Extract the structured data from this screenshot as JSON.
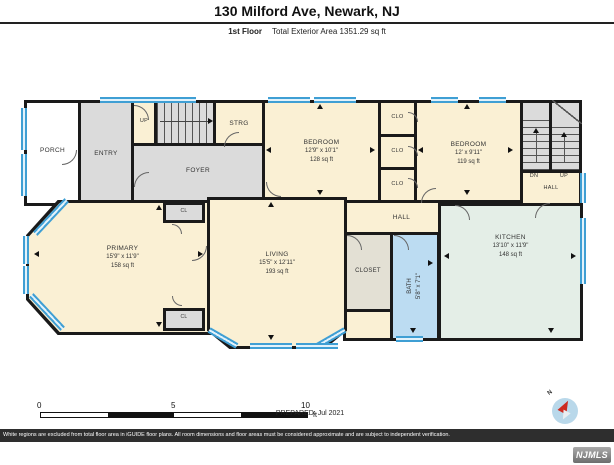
{
  "header": {
    "title": "130 Milford Ave, Newark, NJ",
    "floor": "1st Floor",
    "area": "Total Exterior Area 1351.29 sq ft"
  },
  "rooms": {
    "porch": {
      "label": "PORCH"
    },
    "entry": {
      "label": "ENTRY"
    },
    "foyer": {
      "label": "FOYER"
    },
    "strg": {
      "label": "STRG"
    },
    "stairs_up_left": {
      "label": "UP"
    },
    "bedroom_center": {
      "label": "BEDROOM",
      "dims": "12'9\" x 10'1\"",
      "area": "128 sq ft"
    },
    "bedroom_right": {
      "label": "BEDROOM",
      "dims": "12' x 9'11\"",
      "area": "119 sq ft"
    },
    "clo_top": {
      "label": "CLO"
    },
    "clo_mid": {
      "label": "CLO"
    },
    "clo_bottom": {
      "label": "CLO"
    },
    "stairs_dn": {
      "label": "DN"
    },
    "stairs_up_right": {
      "label": "UP"
    },
    "hall_right": {
      "label": "HALL"
    },
    "hall_center": {
      "label": "HALL"
    },
    "closet": {
      "label": "CLOSET"
    },
    "bath": {
      "label": "BATH",
      "dims": "5'8\" x 7'1\""
    },
    "kitchen": {
      "label": "KITCHEN",
      "dims": "13'10\" x 11'9\"",
      "area": "148 sq ft"
    },
    "primary": {
      "label": "PRIMARY",
      "dims": "15'9\" x 11'9\"",
      "area": "158 sq ft"
    },
    "living": {
      "label": "LIVING",
      "dims": "15'5\" x 12'11\"",
      "area": "193 sq ft"
    },
    "cl_upper": {
      "label": "CL"
    },
    "cl_lower": {
      "label": "CL"
    }
  },
  "scale": {
    "tick0": "0",
    "tick5": "5",
    "tick10": "10",
    "unit": "ft"
  },
  "compass": {
    "label": "N"
  },
  "footer": {
    "prepared": "PREPARED: Jul 2021",
    "disclaimer": "White regions are excluded from total floor area in iGUIDE floor plans. All room dimensions and floor areas must be considered approximate and are subject to independent verification.",
    "logo": "NJMLS"
  },
  "colors": {
    "wall": "#1a1a1a",
    "room_cream": "#faf0d4",
    "room_gray": "#dbdbdb",
    "kitchen_green": "#e4eee7",
    "bath_blue": "#bcdcf2",
    "closet_tan": "#e3e0d4",
    "window_blue": "#3f9fd4"
  }
}
